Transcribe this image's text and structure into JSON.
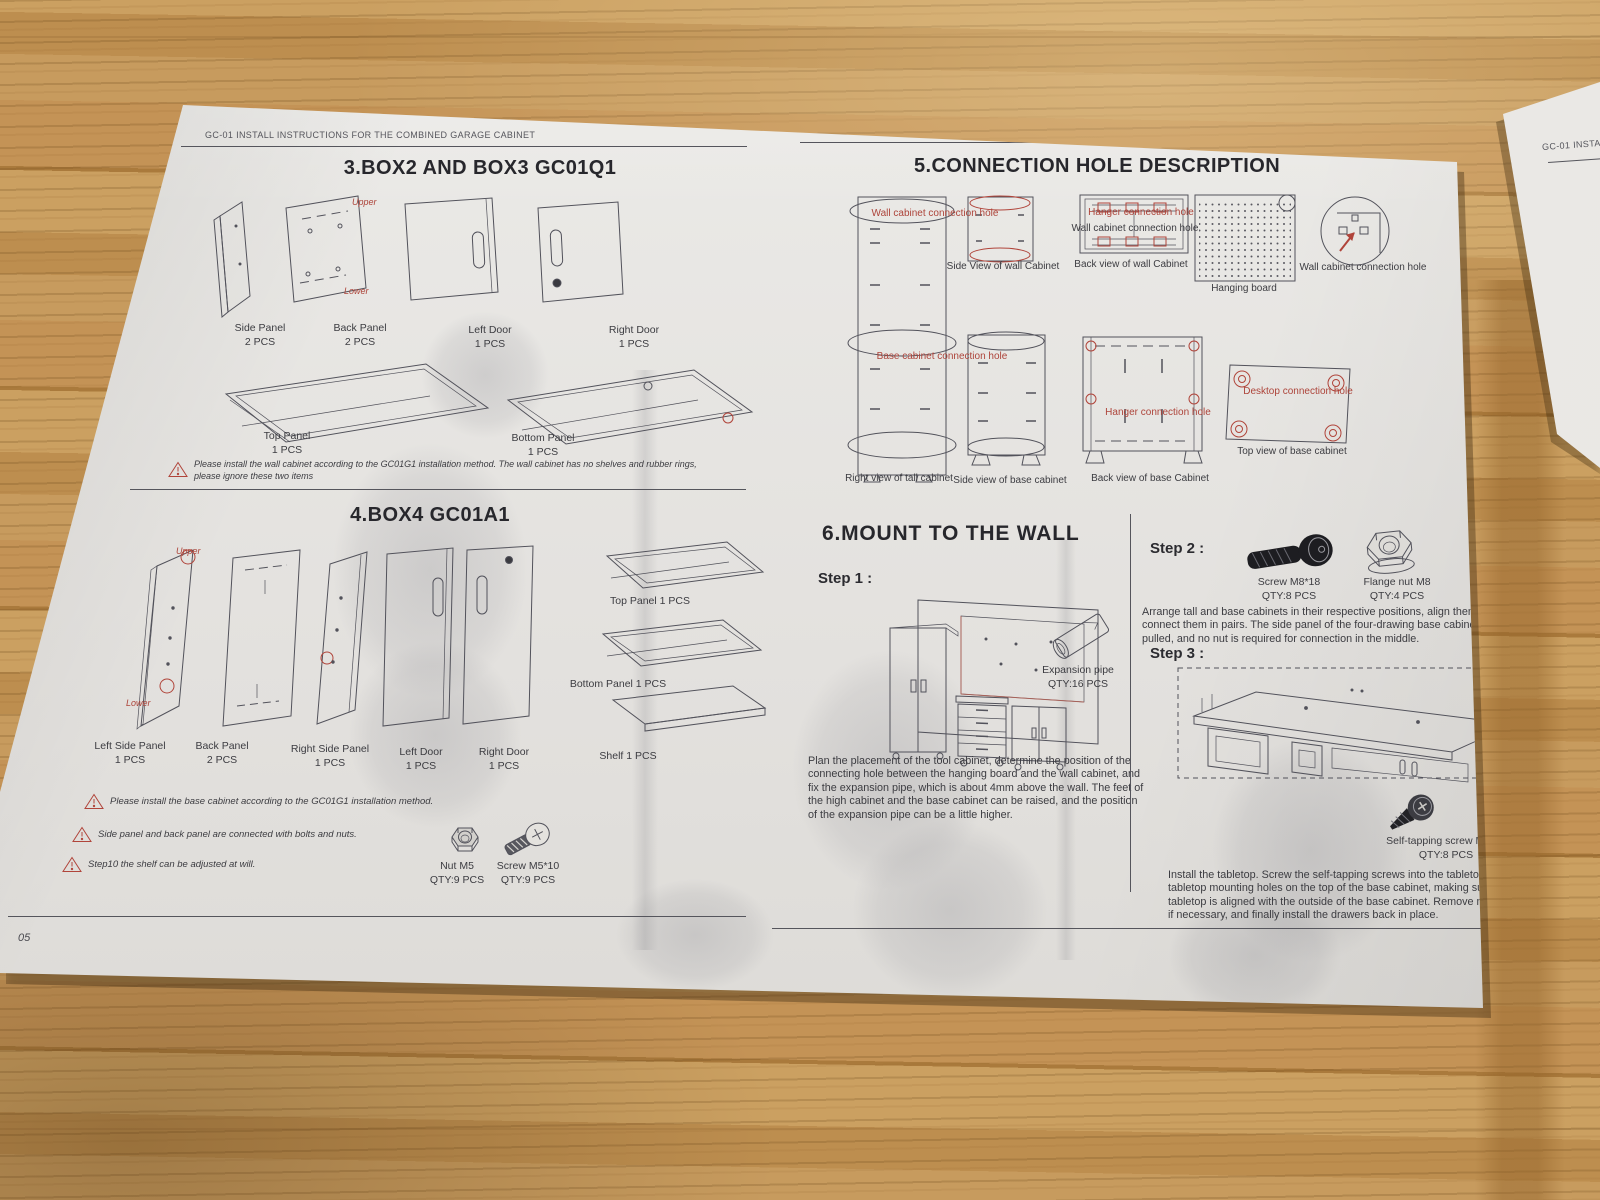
{
  "left_page": {
    "header": "GC-01 INSTALL INSTRUCTIONS  FOR THE COMBINED GARAGE CABINET",
    "page_number": "05",
    "section3": {
      "title": "3.BOX2 AND BOX3 GC01Q1",
      "upper": "Upper",
      "lower": "Lower",
      "parts": [
        {
          "name": "Side Panel",
          "qty": "2 PCS"
        },
        {
          "name": "Back Panel",
          "qty": "2 PCS"
        },
        {
          "name": "Left Door",
          "qty": "1 PCS"
        },
        {
          "name": "Right Door",
          "qty": "1 PCS"
        },
        {
          "name": "Top Panel",
          "qty": "1 PCS"
        },
        {
          "name": "Bottom Panel",
          "qty": "1 PCS"
        }
      ],
      "note_line1": "Please install the wall cabinet according to the GC01G1 installation method. The wall cabinet has no shelves and rubber rings,",
      "note_line2": "please ignore these two items"
    },
    "section4": {
      "title": "4.BOX4  GC01A1",
      "upper": "Upper",
      "lower": "Lower",
      "parts": [
        {
          "name": "Left Side Panel",
          "qty": "1 PCS"
        },
        {
          "name": "Back Panel",
          "qty": "2 PCS"
        },
        {
          "name": "Right Side Panel",
          "qty": "1 PCS"
        },
        {
          "name": "Left Door",
          "qty": "1 PCS"
        },
        {
          "name": "Right Door",
          "qty": "1 PCS"
        }
      ],
      "top_panel": "Top Panel 1 PCS",
      "bottom_panel": "Bottom Panel 1 PCS",
      "shelf": "Shelf 1 PCS",
      "warning1": "Please install the base cabinet according to the GC01G1 installation method.",
      "warning2": "Side panel and back panel are connected with bolts and nuts.",
      "warning3": "Step10 the shelf can be adjusted at will.",
      "nut": {
        "name": "Nut M5",
        "qty": "QTY:9 PCS"
      },
      "screw": {
        "name": "Screw M5*10",
        "qty": "QTY:9 PCS"
      }
    }
  },
  "right_page": {
    "header": "GC-01 INSTALL INSTRUCTIONS  FOR THE COMBINED GARAGE CABINET",
    "page_number": "06",
    "section5": {
      "title": "5.CONNECTION HOLE DESCRIPTION",
      "label_wall_hole": "Wall cabinet connection hole",
      "label_hanger_hole": "Hanger connection hole",
      "label_wall_hole_back": "Wall cabinet connection hole",
      "label_base_hole": "Base cabinet connection hole",
      "label_hanger_hole_base": "Hanger connection hole",
      "label_desktop_hole": "Desktop connection hole",
      "cap_side_wall": "Side View of wall Cabinet",
      "cap_back_wall": "Back view of wall Cabinet",
      "cap_hanging_board": "Hanging board",
      "cap_wall_hole_zoom": "Wall cabinet connection hole",
      "cap_right_tall": "Right view of tall cabinet",
      "cap_side_base": "Side view of base cabinet",
      "cap_back_base": "Back view of base Cabinet",
      "cap_top_base": "Top view of base cabinet"
    },
    "section6": {
      "title": "6.MOUNT TO THE WALL",
      "step1_label": "Step 1 :",
      "step2_label": "Step 2 :",
      "step3_label": "Step 3 :",
      "expansion_pipe": {
        "name": "Expansion pipe",
        "qty": "QTY:16 PCS"
      },
      "screw_m8": {
        "name": "Screw M8*18",
        "qty": "QTY:8 PCS"
      },
      "flange_nut": {
        "name": "Flange nut M8",
        "qty": "QTY:4 PCS"
      },
      "self_tapping": {
        "name": "Self-tapping screw M5*15",
        "qty": "QTY:8 PCS"
      },
      "step1_text": "Plan the placement of the tool cabinet, determine the position of the connecting hole between the hanging board and the wall cabinet, and fix the expansion pipe, which is about 4mm above the wall. The feet of the high cabinet and the base cabinet can be raised, and the position of the expansion pipe can be a little higher.",
      "step2_text": "Arrange tall and base cabinets in their respective positions, align them, and connect them in pairs. The side panel of the four-drawing base cabinet has been pulled, and no nut is required for connection in the middle.",
      "step3_text": "Install the tabletop. Screw the self-tapping screws into the tabletop through the tabletop mounting holes on the top of the base cabinet, making sure that the tabletop is aligned with the outside of the base cabinet. Remove more drawers if necessary, and finally install the drawers back in place."
    }
  },
  "side_sheet": {
    "header_partial": "GC-01 INSTA"
  }
}
